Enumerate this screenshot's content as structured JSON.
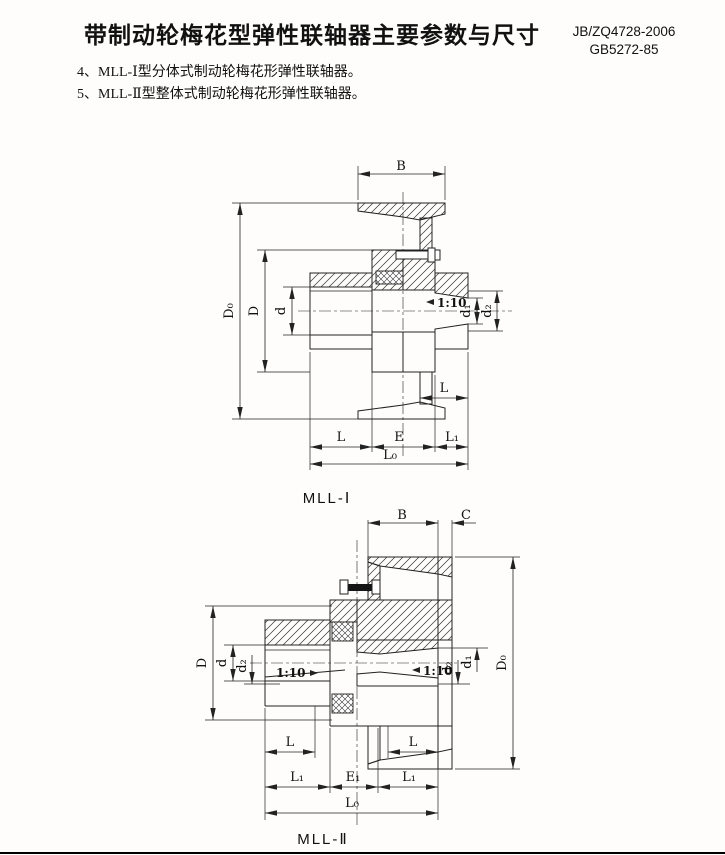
{
  "header": {
    "title": "带制动轮梅花型弹性联轴器主要参数与尺寸",
    "standard_1": "JB/ZQ4728-2006",
    "standard_2": "GB5272-85"
  },
  "notes": {
    "item_4": "4、MLL-Ⅰ型分体式制动轮梅花形弹性联轴器。",
    "item_5": "5、MLL-Ⅱ型整体式制动轮梅花形弹性联轴器。"
  },
  "figure_mll1": {
    "caption": "MLL-Ⅰ",
    "dims": {
      "B": "B",
      "D0": "D₀",
      "D": "D",
      "d": "d",
      "taper": "1:10",
      "d1": "d₁",
      "d2": "d₂",
      "L_wheel_hub": "L",
      "L": "L",
      "E": "E",
      "L1": "L₁",
      "L0": "L₀"
    }
  },
  "figure_mll2": {
    "caption": "MLL-Ⅱ",
    "dims": {
      "B": "B",
      "C": "C",
      "D": "D",
      "d": "d",
      "d2_left": "d₂",
      "taper_left": "1:10",
      "taper_right": "1:10",
      "d2_right": "d₂",
      "d1": "d₁",
      "D0": "D₀",
      "L_left": "L",
      "L_right": "L",
      "L1_left": "L₁",
      "E1": "E₁",
      "L1_right": "L₁",
      "L0": "L₀"
    }
  },
  "colors": {
    "line": "#222222",
    "text": "#111111",
    "background": "#fefdfb"
  }
}
